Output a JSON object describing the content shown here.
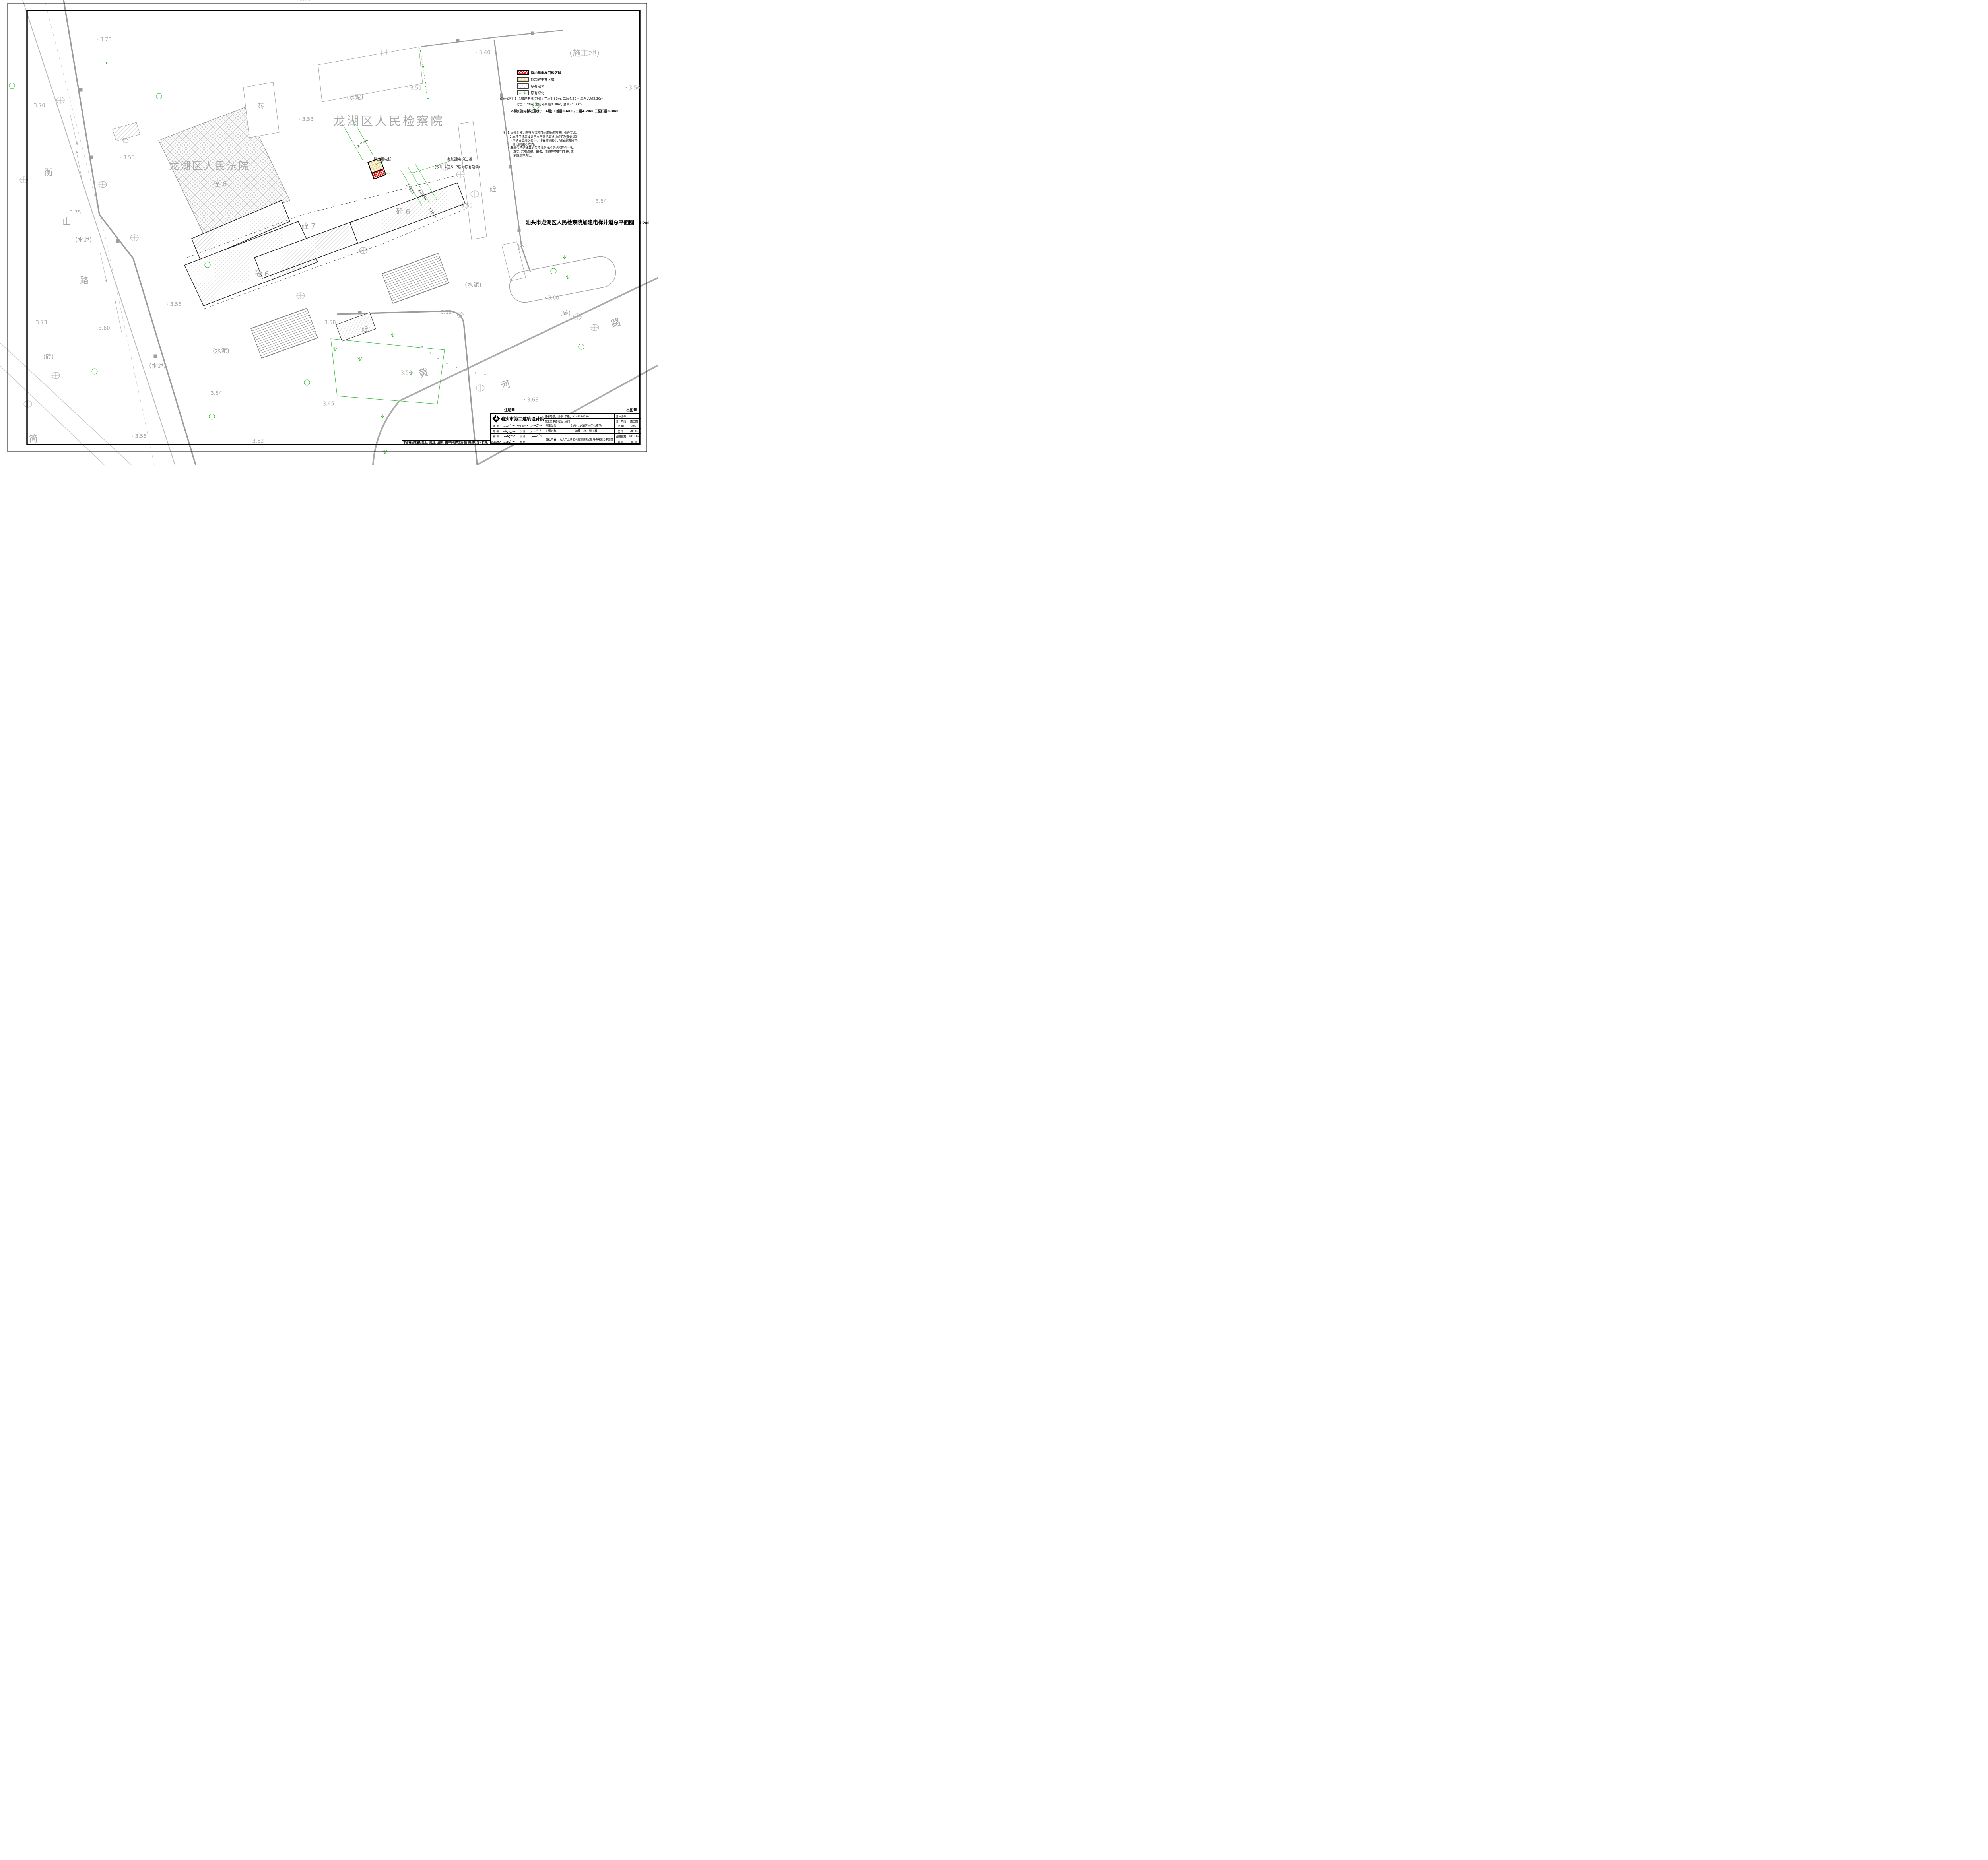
{
  "sheet": {
    "kind": "site-plan-drawing"
  },
  "map": {
    "labels": {
      "elev_tl": "· 3.73",
      "elev_370": "· 3.70",
      "elev_355": "· 3.55",
      "elev_375": "· 3.75",
      "elev_bl373": "· 3.73",
      "elev_bl360": "· 3.60",
      "elev_356m": "· 3.56",
      "elev_358bl": "· 3.58",
      "elev_354b": "· 3.54",
      "elev_362": "· 3.62",
      "elev_345": "· 3.45",
      "elev_353bc": "· 3.53",
      "elev_358c": "· 3.58",
      "elev_352": "· 3.52",
      "elev_360br": "· 3.60",
      "elev_368": "· 3.68",
      "elev_350": "· 3.50",
      "elev_354r": "· 3.54",
      "elev_356tr": "· 3.56",
      "elev_340": "· 3.40",
      "elev_351": "· 3.51",
      "elev_353t": "· 3.53",
      "elev_ptop": "3.73",
      "cem_top": "(水泥)",
      "cem_left": "(水泥)",
      "cem_bl": "(水泥)",
      "cem_bc": "(水泥)",
      "cem_br": "(水泥)",
      "brick_bl": "(砖)",
      "brick_br": "(砖)",
      "brick_bldg": "砖",
      "conc_tl": "砼",
      "conc_r1": "砼",
      "conc_r2": "砼",
      "conc_bc": "砼",
      "conc_352": "砼",
      "conc6_court": "砼 6",
      "conc6_right": "砼 6",
      "conc6_low": "砼 6",
      "conc7": "砼 7",
      "jian": "简",
      "site": "(施工地)",
      "court_name": "龙湖区人民法院",
      "proc_name": "龙湖区人民检察院",
      "heng1": "衡",
      "heng2": "山",
      "heng3": "路",
      "huang1": "黄",
      "huang2": "河",
      "huang3": "路"
    },
    "annotations": {
      "elevator": "拟加建电梯",
      "passage1": "拟加建电梯过道",
      "passage2": "(仅1~4层,5~7层为原有建筑)",
      "dim_2700": "2.700m",
      "dim_2550": "2.550m",
      "dim_3650": "3.650m",
      "dim_1100": "1.100m"
    }
  },
  "legend": {
    "items": [
      {
        "swatch": "red-crosshatch",
        "label": "拟加建电梯门楼区域"
      },
      {
        "swatch": "tan-pattern",
        "label": "拟加建电梯区域"
      },
      {
        "swatch": "diagonal-hatch",
        "label": "原有建筑"
      },
      {
        "swatch": "greenery",
        "label": "原有绿化"
      }
    ]
  },
  "design_notes": {
    "line1": "设计说明: 1.拟加建电梯(7层) : 首层3.60m, 二层4.20m,三至六层3.30m,",
    "line2": "七层2.70m, 室内外高差0.30m, 总高24.00m",
    "line3": "2.拟加建电梯过道楼(1~4层) : 首层3.60m, 二层4.20m,三至四层3.30m."
  },
  "site_notes": {
    "lines": [
      "注: 1.本规划设计图符合该项目的用地规划设计条件要求;",
      "2.本项目建筑设计符合国家建筑设计规范及有关标准;",
      "3.本项目总建筑面积、计容建筑面积, 包括悬挑实体、",
      "阳台的面积在内。",
      "4.我单位承诺计算的各项规划技术指标和图件一致、",
      "真实, 若有虚报、瞒报、造假等不正当手段, 愿",
      "承担法律责任。"
    ]
  },
  "drawing_title": {
    "text": "汕头市龙湖区人民检察院加建电梯井道总平面图",
    "scale": "1:200"
  },
  "stamps": {
    "registration": "注册章",
    "issue": "出图章"
  },
  "bottom_note": "本图需经过报批国土、规划、消防、图审等相关主管部门通过后方可实施。",
  "title_block": {
    "company": "汕头市第二建筑设计院",
    "cert_line": "证书等级、编号: 甲级、A144014299",
    "review_line": "施工图审查批准书编号:",
    "rows_left": [
      {
        "label": "审  定",
        "mid": "专业负责人"
      },
      {
        "label": "审  核",
        "mid": "设  计"
      },
      {
        "label": "校  核",
        "mid": "设  计"
      },
      {
        "label": "项目负责人",
        "mid": "制  图"
      }
    ],
    "info": [
      {
        "label": "兴建单位",
        "value": "汕头市龙湖区人民检察院"
      },
      {
        "label": "工程名称",
        "value": "加建电梯井道工程"
      },
      {
        "label": "图纸内容",
        "value": "汕头市龙湖区人民检察院加建电梯井道总平面图"
      }
    ],
    "meta": {
      "design_no_label": "设计编号",
      "design_no": "",
      "stage_label": "设计阶段",
      "stage": "施工图",
      "cat_label": "图  别",
      "cat": "建筑",
      "no_label": "图  号",
      "no": "ZP-01",
      "date_label": "出图日期",
      "date": "2018.07",
      "sheet_label": "第    张",
      "total_label": "共    张"
    }
  }
}
